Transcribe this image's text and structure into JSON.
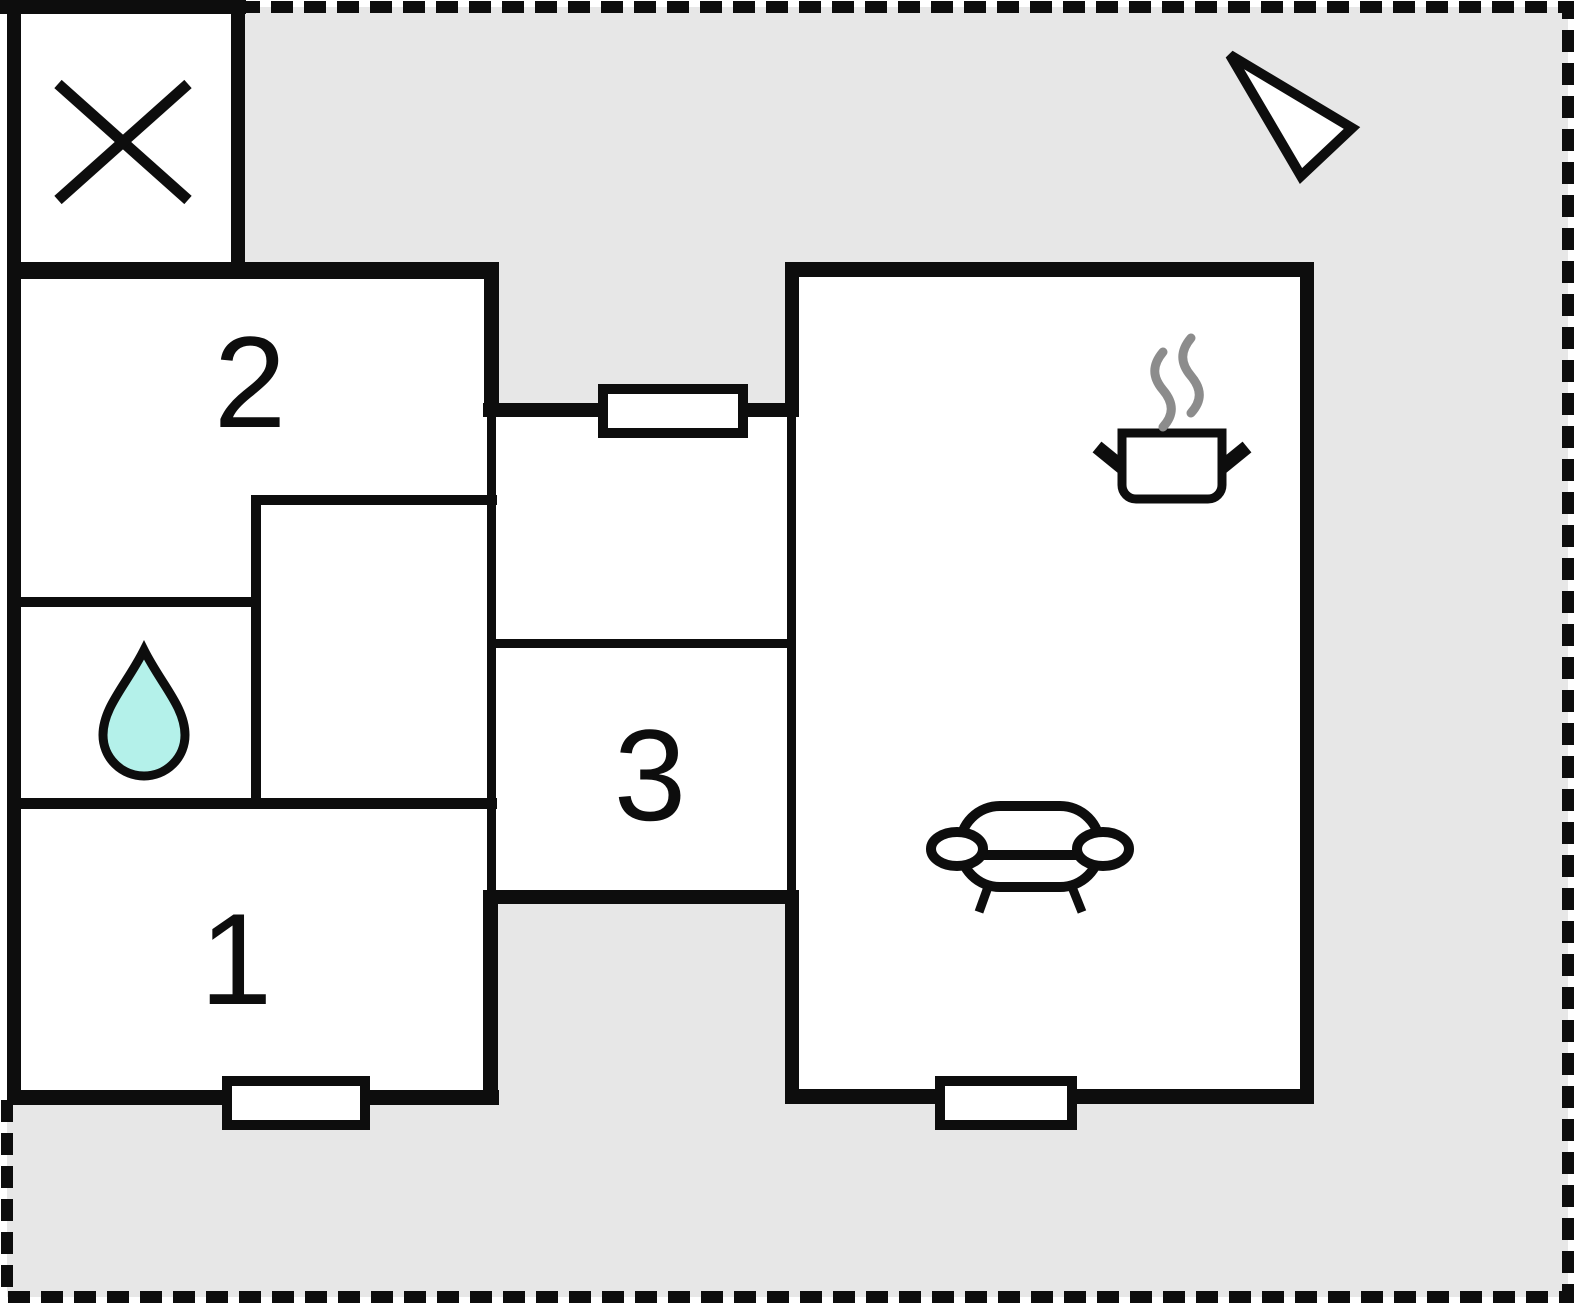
{
  "plan": {
    "rooms": [
      {
        "id": "room-2",
        "label": "2"
      },
      {
        "id": "room-3",
        "label": "3"
      },
      {
        "id": "room-1",
        "label": "1"
      }
    ],
    "icons": [
      "cross-icon",
      "north-arrow-icon",
      "cooking-pot-icon",
      "steam-icon",
      "water-drop-icon",
      "sofa-icon",
      "door-opening",
      "dashed-property-boundary"
    ],
    "colors": {
      "page_background": "#ffffff",
      "property_area": "#e7e7e7",
      "wall": "#0d0d0d",
      "room_fill": "#ffffff",
      "water_drop": "#b4f1ea",
      "steam": "#8c8c8c"
    }
  }
}
